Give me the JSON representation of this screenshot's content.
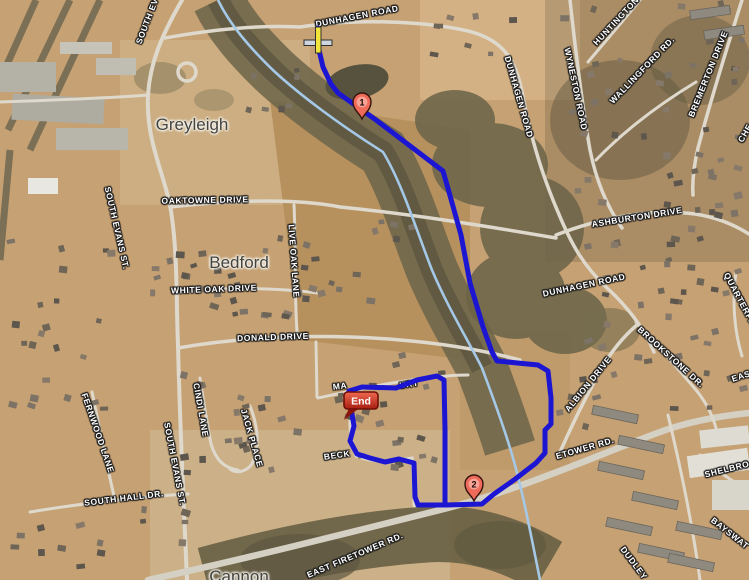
{
  "map": {
    "place_labels": [
      {
        "name": "greyleigh",
        "text": "Greyleigh"
      },
      {
        "name": "bedford",
        "text": "Bedford"
      },
      {
        "name": "cannon",
        "text": "Cannon"
      }
    ],
    "road_labels": [
      {
        "name": "dunhagen-road-top",
        "text": "DUNHAGEN ROAD"
      },
      {
        "name": "south-evans-st-top",
        "text": "SOUTH EV"
      },
      {
        "name": "huntington",
        "text": "HUNTINGTON"
      },
      {
        "name": "wyneston-road",
        "text": "WYNESTON ROAD"
      },
      {
        "name": "wallingford-rd",
        "text": "WALLINGFORD RD."
      },
      {
        "name": "bremerton-drive",
        "text": "BREMERTON DRIVE"
      },
      {
        "name": "che-fragment",
        "text": "CHE"
      },
      {
        "name": "dunhagen-road-right",
        "text": "DUNHAGEN ROAD"
      },
      {
        "name": "oaktowne-drive",
        "text": "OAKTOWNE DRIVE"
      },
      {
        "name": "south-evans-st-mid",
        "text": "SOUTH EVANS ST."
      },
      {
        "name": "white-oak-drive",
        "text": "WHITE OAK DRIVE"
      },
      {
        "name": "live-oak-lane",
        "text": "LIVE OAK LANE"
      },
      {
        "name": "ashburton-drive",
        "text": "ASHBURTON DRIVE"
      },
      {
        "name": "dunhagen-road-mid",
        "text": "DUNHAGEN ROAD"
      },
      {
        "name": "donald-drive",
        "text": "DONALD DRIVE"
      },
      {
        "name": "brookstone-dr",
        "text": "BROOKSTONE DR."
      },
      {
        "name": "quarterpath-fragment",
        "text": "QUARTERPA"
      },
      {
        "name": "albion-drive",
        "text": "ALBION DRIVE"
      },
      {
        "name": "cindi-lane",
        "text": "CINDI LANE"
      },
      {
        "name": "jack-place",
        "text": "JACK PLACE"
      },
      {
        "name": "fernwood-lane",
        "text": "FERNWOOD LANE"
      },
      {
        "name": "south-evans-st-bottom",
        "text": "SOUTH EVANS ST."
      },
      {
        "name": "south-hall-dr",
        "text": "SOUTH HALL DR."
      },
      {
        "name": "beck-fragment",
        "text": "BECK"
      },
      {
        "name": "court-ma-fragment",
        "text": "MA"
      },
      {
        "name": "court-urt-fragment",
        "text": "URT"
      },
      {
        "name": "etower-rd-fragment",
        "text": "ETOWER RD."
      },
      {
        "name": "east-firetower-rd",
        "text": "EAST FIRETOWER RD."
      },
      {
        "name": "eas-fragment",
        "text": "EAS"
      },
      {
        "name": "shelbro-fragment",
        "text": "SHELBRO"
      },
      {
        "name": "bayswat-fragment",
        "text": "BAYSWAT"
      },
      {
        "name": "dudley",
        "text": "DUDLEY"
      }
    ],
    "markers": [
      {
        "name": "waypoint-1",
        "label": "1"
      },
      {
        "name": "waypoint-2",
        "label": "2"
      },
      {
        "name": "end-marker",
        "label": "End"
      }
    ],
    "colors": {
      "route": "#1c16d2",
      "stream": "#a4c8e6",
      "waypoint_pin": "#ee6a59",
      "end_bubble": "#c02314",
      "terrain": "#c6a173"
    }
  }
}
